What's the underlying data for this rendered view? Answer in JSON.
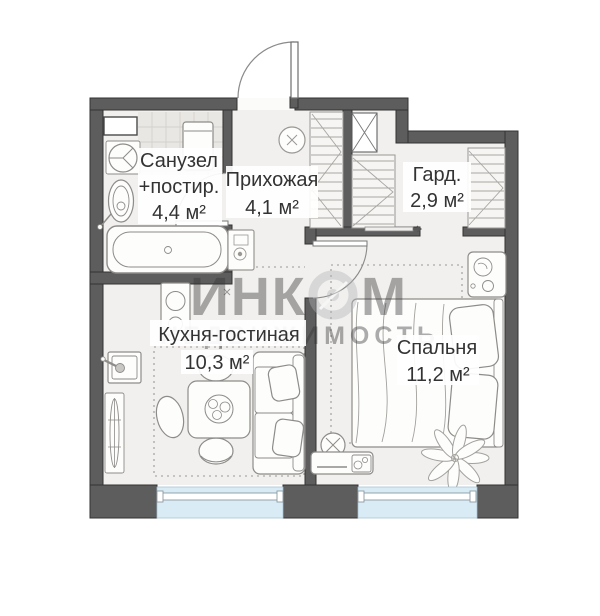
{
  "watermark": {
    "line1_part1": "ИНК",
    "line1_part2": "М",
    "line2": "НЕДВИЖИМОСТЬ"
  },
  "rooms": {
    "bathroom": {
      "name": "Санузел",
      "name2": "+постир.",
      "area": "4,4 м²"
    },
    "hallway": {
      "name": "Прихожая",
      "area": "4,1 м²"
    },
    "wardrobe": {
      "name": "Гард.",
      "area": "2,9 м²"
    },
    "kitchen": {
      "name": "Кухня-гостиная",
      "area": "10,3 м²"
    },
    "bedroom": {
      "name": "Спальня",
      "area": "11,2 м²"
    }
  },
  "colors": {
    "wall": "#5d5d5d",
    "floor": "#f1f0ee",
    "tile": "#e9e7e3",
    "glass": "#d9ecf5",
    "text": "#333333",
    "watermark": "#bcbcc0"
  }
}
